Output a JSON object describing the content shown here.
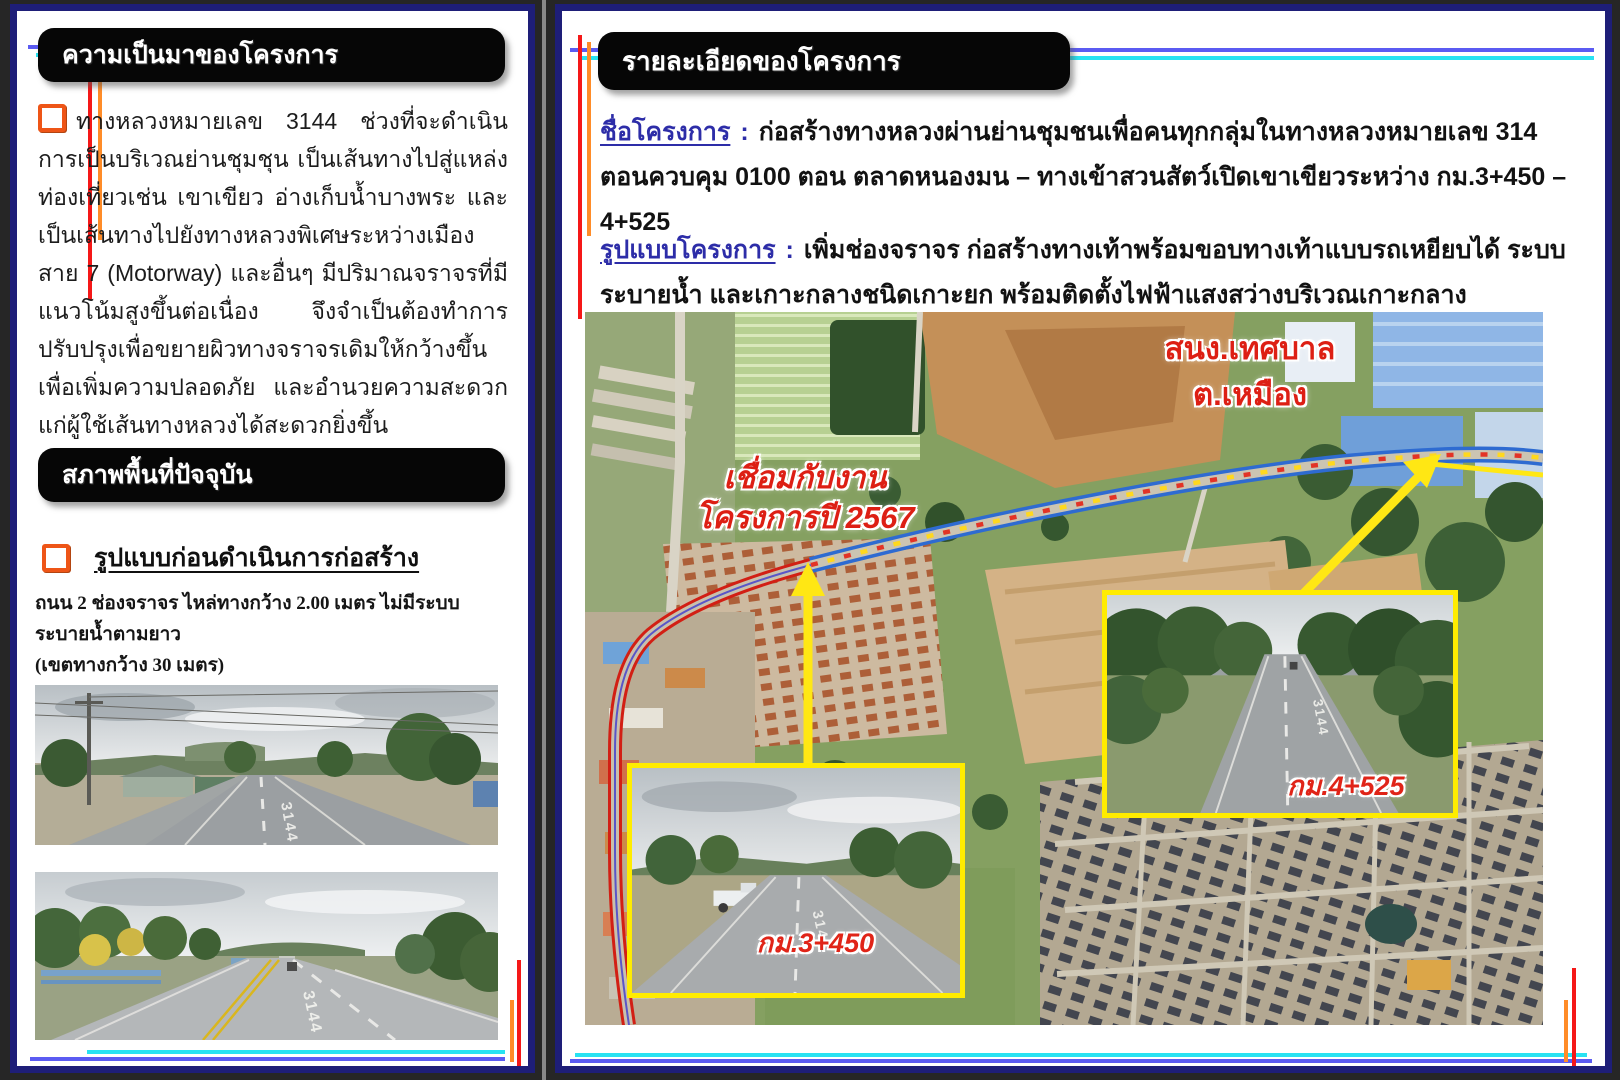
{
  "page_left": {
    "section1_title": "ความเป็นมาของโครงการ",
    "section1_body": "ทางหลวงหมายเลข 3144 ช่วงที่จะดำเนินการเป็นบริเวณย่านชุมชุน เป็นเส้นทางไปสู่แหล่งท่องเที่ยวเช่น เขาเขียว อ่างเก็บน้ำบางพระ และเป็นเส้นทางไปยังทางหลวงพิเศษระหว่างเมืองสาย 7 (Motorway) และอื่นๆ มีปริมาณจราจรที่มีแนวโน้มสูงขึ้นต่อเนื่อง จึงจำเป็นต้องทำการปรับปรุงเพื่อขยายผิวทางจราจรเดิมให้กว้างขึ้น เพื่อเพิ่มความปลอดภัย และอำนวยความสะดวก แก่ผู้ใช้เส้นทางหลวงได้สะดวกยิ่งขึ้น",
    "section2_title": "สภาพพื้นที่ปัจจุบัน",
    "subheading": "รูปแบบก่อนดำเนินการก่อสร้าง",
    "note_line1": "ถนน 2 ช่องจราจร ไหล่ทางกว้าง 2.00 เมตร ไม่มีระบบระบายน้ำตามยาว",
    "note_line2": "(เขตทางกว้าง 30 เมตร)",
    "photo1_road_number": "3144",
    "photo2_road_number": "3144"
  },
  "page_right": {
    "section_title": "รายละเอียดของโครงการ",
    "project_name_label": "ชื่อโครงการ",
    "project_name_colon": ":",
    "project_name_text": "ก่อสร้างทางหลวงผ่านย่านชุมชนเพื่อคนทุกกลุ่มในทางหลวงหมายเลข 314 ตอนควบคุม 0100 ตอน ตลาดหนองมน – ทางเข้าสวนสัตว์เปิดเขาเขียวระหว่าง กม.3+450 – 4+525",
    "project_form_label": "รูปแบบโครงการ",
    "project_form_colon": ":",
    "project_form_text": "เพิ่มช่องจราจร ก่อสร้างทางเท้าพร้อมขอบทางเท้าแบบรถเหยียบได้ ระบบระบายน้ำ และเกาะกลางชนิดเกาะยก พร้อมติดตั้งไฟฟ้าแสงสว่างบริเวณเกาะกลาง",
    "map": {
      "label_office_line1": "สนง.เทศบาล",
      "label_office_line2": "ต.เหมือง",
      "label_connect_line1": "เชื่อมกับงาน",
      "label_connect_line2": "โครงการปี 2567",
      "inset1_label": "กม.3+450",
      "inset2_label": "กม.4+525",
      "inset1_road_number": "3144",
      "inset2_road_number": "3144"
    }
  },
  "colors": {
    "page_border_navy": "#1e1e78",
    "header_bg": "#060606",
    "checkbox_orange": "#ee5517",
    "label_blue": "#2d2da8",
    "annotation_red": "#dd1f14",
    "inset_border_yellow": "#ffec00",
    "decor_blue": "#5b5bf2",
    "decor_cyan": "#28e2f2",
    "decor_red": "#f51818",
    "decor_orange": "#ff8c28"
  }
}
